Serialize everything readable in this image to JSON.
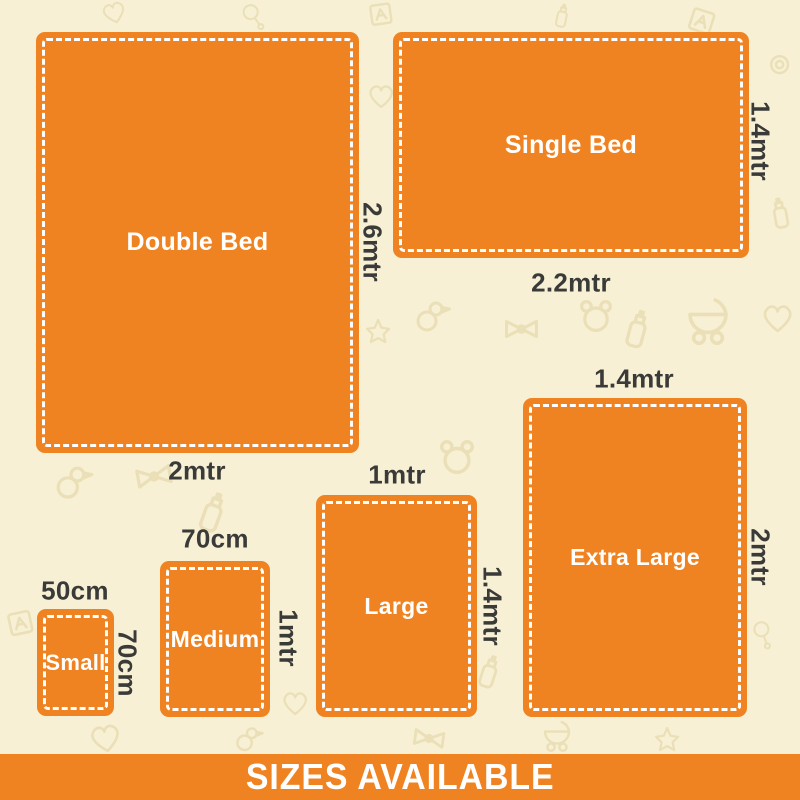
{
  "title_banner": {
    "label": "SIZES AVAILABLE"
  },
  "colors": {
    "accent_orange": "#F08321",
    "background_cream": "#F7F0D4",
    "pattern_beige": "#E8DCB0",
    "dimension_text": "#3A3A38",
    "box_text": "#FFFFFF"
  },
  "sizes": [
    {
      "name": "Double Bed",
      "width_label": "2mtr",
      "height_label": "2.6mtr"
    },
    {
      "name": "Single Bed",
      "width_label": "2.2mtr",
      "height_label": "1.4mtr"
    },
    {
      "name": "Small",
      "width_label": "50cm",
      "height_label": "70cm"
    },
    {
      "name": "Medium",
      "width_label": "70cm",
      "height_label": "1mtr"
    },
    {
      "name": "Large",
      "width_label": "1mtr",
      "height_label": "1.4mtr"
    },
    {
      "name": "Extra Large",
      "width_label": "1.4mtr",
      "height_label": "2mtr"
    }
  ]
}
